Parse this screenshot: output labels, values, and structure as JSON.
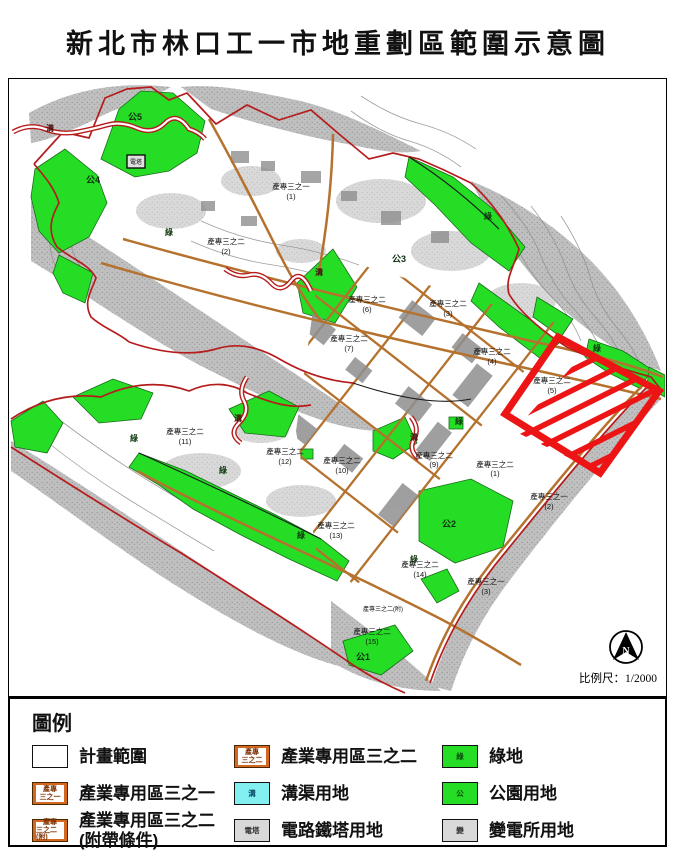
{
  "title": "新北市林口工一市地重劃區範圍示意圖",
  "colors": {
    "boundary_red": "#b51d1d",
    "highlight_red": "#ec1414",
    "green_land": "#25dd25",
    "road_orange": "#b5722e",
    "ditch_cyan": "#82f0f0",
    "terrain_gray": "#a3a3a3"
  },
  "map": {
    "scale_label": "比例尺：1/2000",
    "north_label": "N",
    "labels": [
      {
        "t": "公5",
        "x": 134,
        "y": 119,
        "c": "park"
      },
      {
        "t": "公4",
        "x": 92,
        "y": 182,
        "c": "park"
      },
      {
        "t": "公3",
        "x": 398,
        "y": 261,
        "c": "park"
      },
      {
        "t": "公2",
        "x": 448,
        "y": 526,
        "c": "park"
      },
      {
        "t": "公1",
        "x": 362,
        "y": 659,
        "c": "park"
      },
      {
        "t": "綠",
        "x": 168,
        "y": 234,
        "c": "green"
      },
      {
        "t": "綠",
        "x": 487,
        "y": 218,
        "c": "green"
      },
      {
        "t": "綠",
        "x": 133,
        "y": 440,
        "c": "green"
      },
      {
        "t": "綠",
        "x": 222,
        "y": 472,
        "c": "green"
      },
      {
        "t": "綠",
        "x": 300,
        "y": 537,
        "c": "green"
      },
      {
        "t": "綠",
        "x": 596,
        "y": 350,
        "c": "green"
      },
      {
        "t": "綠",
        "x": 458,
        "y": 423,
        "c": "green"
      },
      {
        "t": "綠",
        "x": 413,
        "y": 561,
        "c": "green"
      },
      {
        "t": "溝",
        "x": 49,
        "y": 130,
        "c": "ditch"
      },
      {
        "t": "溝",
        "x": 318,
        "y": 274,
        "c": "ditch"
      },
      {
        "t": "溝",
        "x": 237,
        "y": 420,
        "c": "ditch"
      },
      {
        "t": "溝",
        "x": 413,
        "y": 439,
        "c": "ditch"
      },
      {
        "t": "電塔",
        "x": 135,
        "y": 163,
        "c": "tower"
      },
      {
        "t": "產專三之一",
        "x": 290,
        "y": 188
      },
      {
        "t": "(1)",
        "x": 290,
        "y": 198
      },
      {
        "t": "產專三之二",
        "x": 225,
        "y": 243
      },
      {
        "t": "(2)",
        "x": 225,
        "y": 253
      },
      {
        "t": "產專三之二",
        "x": 366,
        "y": 301
      },
      {
        "t": "(6)",
        "x": 366,
        "y": 311
      },
      {
        "t": "產專三之二",
        "x": 447,
        "y": 305
      },
      {
        "t": "(3)",
        "x": 447,
        "y": 315
      },
      {
        "t": "產專三之二",
        "x": 348,
        "y": 340
      },
      {
        "t": "(7)",
        "x": 348,
        "y": 350
      },
      {
        "t": "產專三之二",
        "x": 491,
        "y": 353
      },
      {
        "t": "(4)",
        "x": 491,
        "y": 363
      },
      {
        "t": "產專三之二",
        "x": 551,
        "y": 382
      },
      {
        "t": "(5)",
        "x": 551,
        "y": 392
      },
      {
        "t": "產專三之二",
        "x": 184,
        "y": 433
      },
      {
        "t": "(11)",
        "x": 184,
        "y": 443
      },
      {
        "t": "產專三之二",
        "x": 284,
        "y": 453
      },
      {
        "t": "(12)",
        "x": 284,
        "y": 463
      },
      {
        "t": "產專三之二",
        "x": 341,
        "y": 462
      },
      {
        "t": "(10)",
        "x": 341,
        "y": 472
      },
      {
        "t": "產專三之二",
        "x": 433,
        "y": 457
      },
      {
        "t": "(9)",
        "x": 433,
        "y": 466
      },
      {
        "t": "產專三之二",
        "x": 494,
        "y": 466
      },
      {
        "t": "(1)",
        "x": 494,
        "y": 475
      },
      {
        "t": "產專三之一",
        "x": 548,
        "y": 498
      },
      {
        "t": "(2)",
        "x": 548,
        "y": 508
      },
      {
        "t": "產專三之二",
        "x": 335,
        "y": 527
      },
      {
        "t": "(13)",
        "x": 335,
        "y": 537
      },
      {
        "t": "產專三之二",
        "x": 419,
        "y": 566
      },
      {
        "t": "(14)",
        "x": 419,
        "y": 576
      },
      {
        "t": "產專三之一",
        "x": 485,
        "y": 583
      },
      {
        "t": "(3)",
        "x": 485,
        "y": 593
      },
      {
        "t": "產專三之二(附)",
        "x": 382,
        "y": 610,
        "c": "tiny"
      },
      {
        "t": "產專三之二",
        "x": 371,
        "y": 633
      },
      {
        "t": "(15)",
        "x": 371,
        "y": 643
      }
    ]
  },
  "legend": {
    "title": "圖例",
    "items": [
      {
        "id": "plan-boundary",
        "swatch": "plan",
        "swatch_lines": [],
        "label": "計畫範圍",
        "label2": ""
      },
      {
        "id": "zone-3-1",
        "swatch": "orange",
        "swatch_lines": [
          "產專",
          "三之一"
        ],
        "label": "產業專用區三之一",
        "label2": ""
      },
      {
        "id": "zone-3-2-cond",
        "swatch": "orange",
        "swatch_lines": [
          "產專",
          "三之二(附)"
        ],
        "label": "產業專用區三之二",
        "label2": "(附帶條件)"
      },
      {
        "id": "zone-3-2",
        "swatch": "orange",
        "swatch_lines": [
          "產專",
          "三之二"
        ],
        "label": "產業專用區三之二",
        "label2": ""
      },
      {
        "id": "ditch",
        "swatch": "cyan",
        "swatch_lines": [
          "溝"
        ],
        "label": "溝渠用地",
        "label2": ""
      },
      {
        "id": "tower",
        "swatch": "gray",
        "swatch_lines": [
          "電塔"
        ],
        "label": "電路鐵塔用地",
        "label2": ""
      },
      {
        "id": "green-land",
        "swatch": "green",
        "swatch_lines": [
          "綠"
        ],
        "label": "綠地",
        "label2": ""
      },
      {
        "id": "park",
        "swatch": "green",
        "swatch_lines": [
          "公"
        ],
        "label": "公園用地",
        "label2": ""
      },
      {
        "id": "substation",
        "swatch": "gray",
        "swatch_lines": [
          "變"
        ],
        "label": "變電所用地",
        "label2": ""
      }
    ]
  }
}
